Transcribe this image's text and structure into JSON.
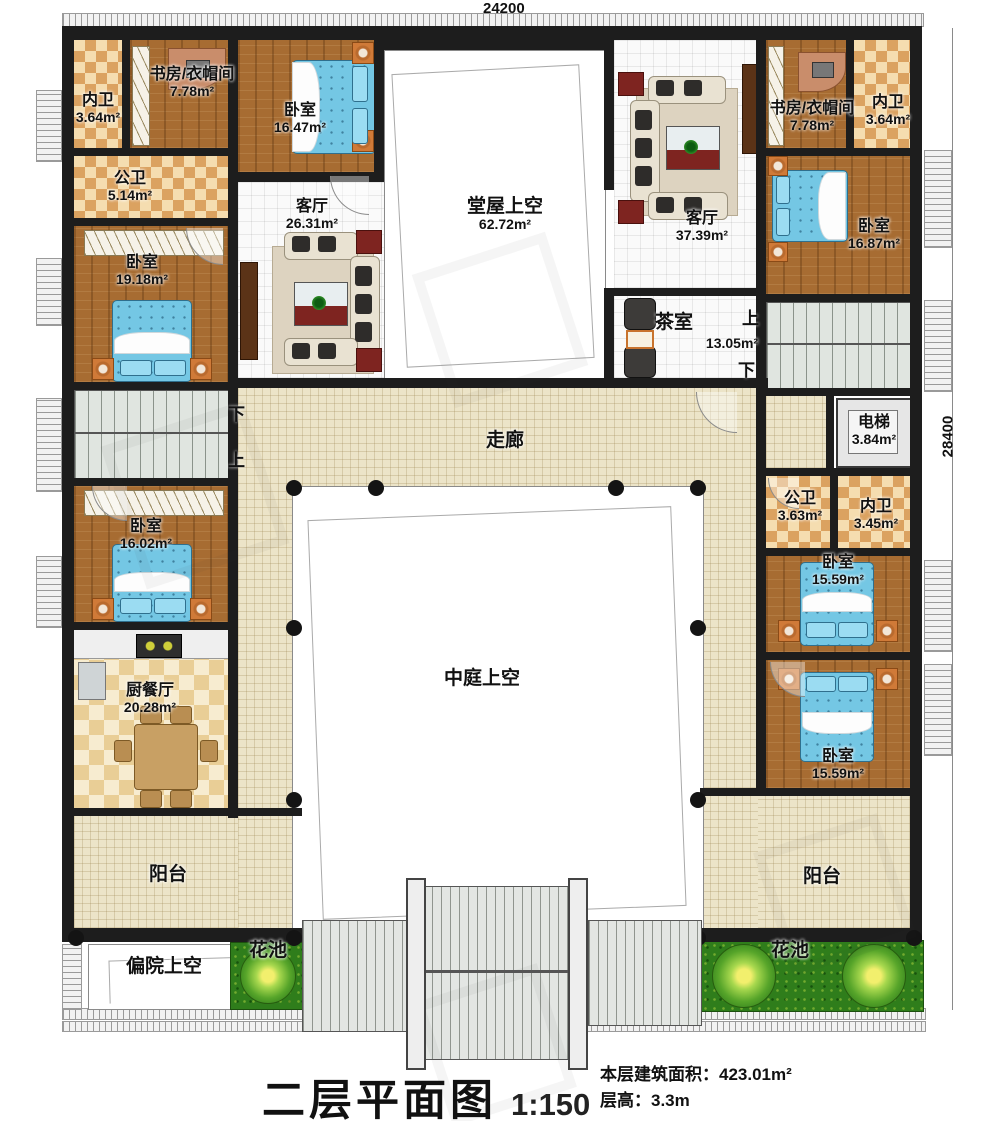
{
  "dimensions": {
    "top": "24200",
    "right": "28400"
  },
  "stair_labels": {
    "up": "上",
    "down": "下"
  },
  "rooms": {
    "nw_innerbath": {
      "label": "内卫",
      "area": "3.64m²"
    },
    "nw_study": {
      "label": "书房/衣帽间",
      "area": "7.78m²"
    },
    "nw_bedroom": {
      "label": "卧室",
      "area": "16.47m²"
    },
    "w_publicbath": {
      "label": "公卫",
      "area": "5.14m²"
    },
    "w_living": {
      "label": "客厅",
      "area": "26.31m²"
    },
    "hall_void": {
      "label": "堂屋上空",
      "area": "62.72m²"
    },
    "e_living": {
      "label": "客厅",
      "area": "37.39m²"
    },
    "ne_study": {
      "label": "书房/衣帽间",
      "area": "7.78m²"
    },
    "ne_innerbath": {
      "label": "内卫",
      "area": "3.64m²"
    },
    "ne_bedroom": {
      "label": "卧室",
      "area": "16.87m²"
    },
    "w_bedroom": {
      "label": "卧室",
      "area": "19.18m²"
    },
    "tea_room": {
      "label": "茶室",
      "area": "13.05m²"
    },
    "elevator": {
      "label": "电梯",
      "area": "3.84m²"
    },
    "corridor": {
      "label": "走廊"
    },
    "e_publicbath": {
      "label": "公卫",
      "area": "3.63m²"
    },
    "e_innerbath": {
      "label": "内卫",
      "area": "3.45m²"
    },
    "sw_bedroom": {
      "label": "卧室",
      "area": "16.02m²"
    },
    "se_bedroom_upper": {
      "label": "卧室",
      "area": "15.59m²"
    },
    "atrium_void": {
      "label": "中庭上空"
    },
    "kitchen": {
      "label": "厨餐厅",
      "area": "20.28m²"
    },
    "se_bedroom_lower": {
      "label": "卧室",
      "area": "15.59m²"
    },
    "balcony_left": {
      "label": "阳台"
    },
    "balcony_right": {
      "label": "阳台"
    },
    "side_yard_void": {
      "label": "偏院上空"
    },
    "flower_bed_left": {
      "label": "花池"
    },
    "flower_bed_right": {
      "label": "花池"
    }
  },
  "title_block": {
    "title": "二层平面图",
    "scale": "1:150",
    "area_line": "本层建筑面积：423.01m²",
    "height_line": "层高：3.3m"
  }
}
